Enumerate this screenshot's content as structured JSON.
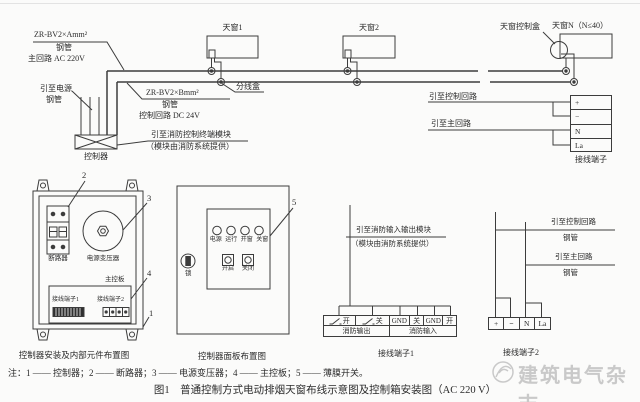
{
  "top_diagram": {
    "main_spec": "ZR-BV2×Amm²",
    "main_conduit": "钢管",
    "main_circuit": "主回路 AC 220V",
    "power_lead": "引至电源",
    "power_conduit": "钢管",
    "controller": "控制器",
    "ctrl_spec": "ZR-BV2×Bmm²",
    "ctrl_conduit": "钢管",
    "ctrl_circuit": "控制回路 DC 24V",
    "fire_module_lead": "引至消防控制终端模块",
    "fire_module_note": "（模块由消防系统提供）",
    "junction_box": "分线盒",
    "skylight1": "天窗1",
    "skylight2": "天窗2",
    "skylightN": "天窗N（N≤40）",
    "skylight_ctrl_box": "天窗控制盒",
    "to_control_circuit": "引至控制回路",
    "to_main_circuit": "引至主回路",
    "terminal_caption": "接线端子",
    "terminal_cells": [
      "+",
      "−",
      "N",
      "La"
    ]
  },
  "controller_detail": {
    "caption": "控制器安装及内部元件布置图",
    "breaker": "断路器",
    "transformer": "电源变压器",
    "main_board": "主控板",
    "terminal1": "接线端子1",
    "terminal2": "接线端子2",
    "refs": {
      "r1": "1",
      "r2": "2",
      "r3": "3",
      "r4": "4"
    }
  },
  "panel_detail": {
    "caption": "控制器面板布置图",
    "indicators": [
      "电源",
      "运行",
      "开窗",
      "关窗"
    ],
    "open_button": "开启",
    "close_button": "关闭",
    "lock": "锁",
    "ref5": "5"
  },
  "terminal1_detail": {
    "caption": "接线端子1",
    "lead_label": "引至消防输入输出模块",
    "lead_note": "（模块由消防系统提供）",
    "cells": [
      "开",
      "关",
      "GND",
      "关",
      "GND",
      "开"
    ],
    "groups": [
      "消防输出",
      "消防输入"
    ]
  },
  "terminal2_detail": {
    "caption": "接线端子2",
    "to_control_circuit": "引至控制回路",
    "control_conduit": "钢管",
    "to_main_circuit": "引至主回路",
    "main_conduit": "钢管",
    "cells": [
      "+",
      "−",
      "N",
      "La"
    ]
  },
  "footer": {
    "notes": "注：1 —— 控制器；2 —— 断路器；3 —— 电源变压器；4 —— 主控板；5 —— 薄膜开关。",
    "figure_title": "图1　普通控制方式电动排烟天窗布线示意图及控制箱安装图（AC 220 V）",
    "watermark": "建筑电气杂志"
  },
  "colors": {
    "line": "#3c3c3c",
    "text": "#2b2b2b",
    "watermark": "#c9c9c9",
    "background": "#fbfbfa"
  }
}
